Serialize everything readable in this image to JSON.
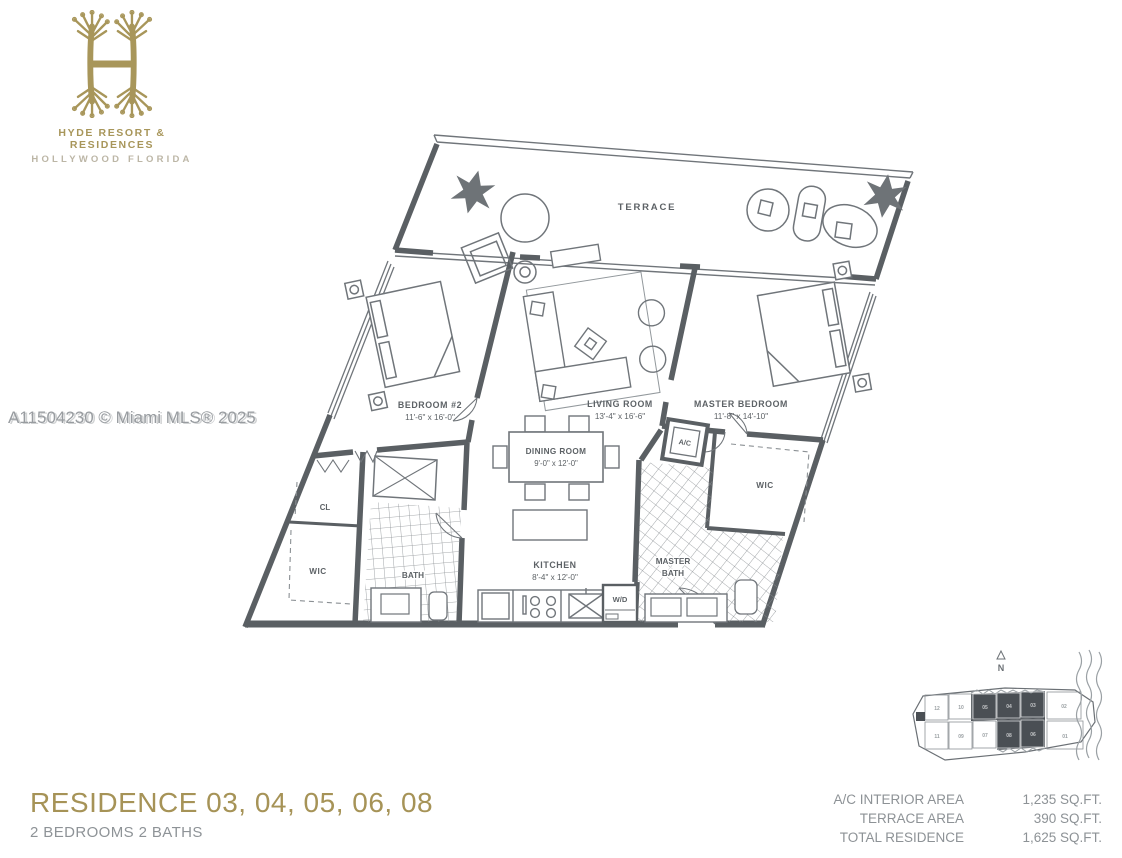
{
  "brand": {
    "line1": "HYDE RESORT & RESIDENCES",
    "line2": "HOLLYWOOD FLORIDA"
  },
  "watermark": "A11504230 © Miami MLS® 2025",
  "floor_plan": {
    "terrace_label": "TERRACE",
    "rooms": [
      {
        "label": "BEDROOM #2",
        "dims": "11'-6\" x 16'-0\""
      },
      {
        "label": "LIVING ROOM",
        "dims": "13'-4\" x 16'-6\""
      },
      {
        "label": "MASTER BEDROOM",
        "dims": "11'-8\" x 14'-10\""
      },
      {
        "label": "DINING ROOM",
        "dims": "9'-0\" x 12'-0\""
      },
      {
        "label": "KITCHEN",
        "dims": "8'-4\" x 12'-0\""
      }
    ],
    "small_labels": {
      "wic_left": "WIC",
      "cl": "CL",
      "bath": "BATH",
      "master_bath_line1": "MASTER",
      "master_bath_line2": "BATH",
      "wic_right": "WIC",
      "wd": "W/D",
      "ac": "A/C"
    }
  },
  "keyplan": {
    "north_label": "N",
    "top_row": [
      "12",
      "10",
      "05",
      "04",
      "03",
      "02"
    ],
    "bottom_row": [
      "11",
      "09",
      "07",
      "08",
      "06",
      "01"
    ],
    "highlighted_units": [
      "03",
      "04",
      "05",
      "06",
      "08"
    ]
  },
  "footer": {
    "title": "RESIDENCE 03, 04, 05, 06, 08",
    "subtitle": "2 BEDROOMS 2 BATHS"
  },
  "stats": {
    "rows": [
      {
        "label": "A/C INTERIOR AREA",
        "value": "1,235 SQ.FT."
      },
      {
        "label": "TERRACE AREA",
        "value": "390 SQ.FT."
      },
      {
        "label": "TOTAL RESIDENCE",
        "value": "1,625 SQ.FT."
      }
    ]
  },
  "colors": {
    "gold": "#a8965a",
    "wall": "#5a5f63",
    "line": "#70757a",
    "text_gray": "#8d9296",
    "highlight": "#4a4f54"
  }
}
